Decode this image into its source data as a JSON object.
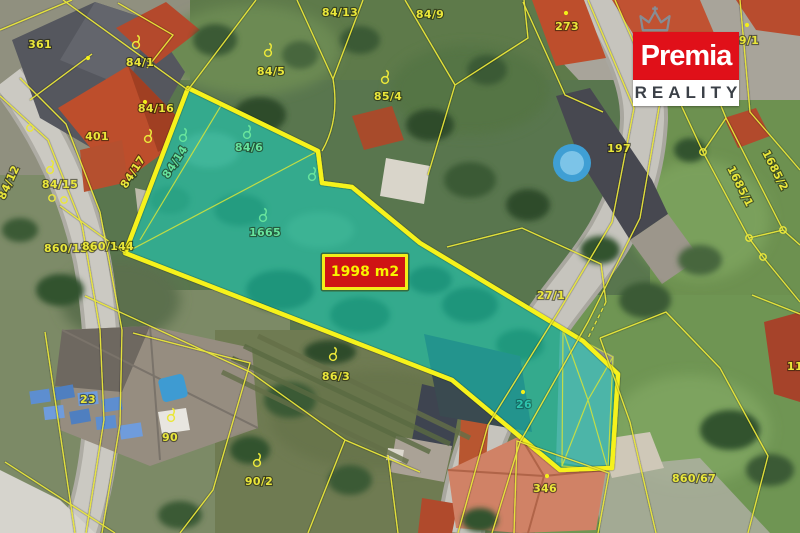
{
  "logo": {
    "brand": "Premia",
    "subtitle": "REALITY",
    "crown_icon": "crown",
    "brand_bg": "#e01019",
    "subtitle_color": "#3b4047"
  },
  "area_label": {
    "text": "1998 m2",
    "bg": "#cf1414",
    "border": "#f2ee19",
    "color": "#f8f400"
  },
  "map": {
    "type": "cadastral-aerial-overlay",
    "highlight_fill": "#0fd8c6",
    "highlight_border": "#f6f21a",
    "parcel_line_color": "#eae73a",
    "label_color": "#eae73a",
    "label_color_in_highlight": "#67e39c",
    "parcel_labels": [
      {
        "text": "361",
        "x": 40,
        "y": 48
      },
      {
        "text": "84/1",
        "x": 140,
        "y": 66
      },
      {
        "text": "401",
        "x": 97,
        "y": 140
      },
      {
        "text": "84/16",
        "x": 156,
        "y": 112
      },
      {
        "text": "84/15",
        "x": 60,
        "y": 188
      },
      {
        "text": "84/12",
        "x": 12,
        "y": 184,
        "rot": -65
      },
      {
        "text": "84/17",
        "x": 136,
        "y": 174,
        "rot": -57
      },
      {
        "text": "860/130",
        "x": 70,
        "y": 252
      },
      {
        "text": "860/144",
        "x": 108,
        "y": 250
      },
      {
        "text": "84/13",
        "x": 340,
        "y": 16
      },
      {
        "text": "84/5",
        "x": 271,
        "y": 75
      },
      {
        "text": "85/4",
        "x": 388,
        "y": 100
      },
      {
        "text": "84/9",
        "x": 430,
        "y": 18
      },
      {
        "text": "273",
        "x": 567,
        "y": 30
      },
      {
        "text": "9/1",
        "x": 749,
        "y": 44
      },
      {
        "text": "197",
        "x": 619,
        "y": 152
      },
      {
        "text": "1685/1",
        "x": 737,
        "y": 188,
        "rot": 63
      },
      {
        "text": "1685/2",
        "x": 772,
        "y": 172,
        "rot": 63
      },
      {
        "text": "27/1",
        "x": 551,
        "y": 299
      },
      {
        "text": "86/3",
        "x": 336,
        "y": 380
      },
      {
        "text": "90/2",
        "x": 259,
        "y": 485
      },
      {
        "text": "23",
        "x": 88,
        "y": 403
      },
      {
        "text": "90",
        "x": 170,
        "y": 441
      },
      {
        "text": "346",
        "x": 545,
        "y": 492
      },
      {
        "text": "860/67",
        "x": 694,
        "y": 482
      },
      {
        "text": "11",
        "x": 795,
        "y": 370
      },
      {
        "text": "84/14",
        "x": 178,
        "y": 164,
        "rot": -57,
        "cls": "green"
      },
      {
        "text": "84/6",
        "x": 249,
        "y": 151,
        "cls": "green"
      },
      {
        "text": "1665",
        "x": 265,
        "y": 236,
        "cls": "green"
      },
      {
        "text": "26",
        "x": 524,
        "y": 408,
        "cls": "teal"
      }
    ],
    "land_use_symbols_yellow": [
      [
        136,
        45
      ],
      [
        268,
        53
      ],
      [
        385,
        80
      ],
      [
        50,
        170
      ],
      [
        148,
        139
      ],
      [
        333,
        357
      ],
      [
        257,
        463
      ],
      [
        171,
        418
      ]
    ],
    "land_use_symbols_green": [
      [
        247,
        135
      ],
      [
        263,
        218
      ],
      [
        183,
        138
      ],
      [
        312,
        177
      ]
    ],
    "boundary_nodes": [
      [
        30,
        128
      ],
      [
        52,
        198
      ],
      [
        64,
        200
      ],
      [
        703,
        152
      ],
      [
        749,
        238
      ],
      [
        763,
        257
      ],
      [
        783,
        230
      ]
    ],
    "point_dots": [
      [
        88,
        58
      ],
      [
        145,
        102
      ],
      [
        566,
        13
      ],
      [
        547,
        476
      ],
      [
        523,
        392
      ],
      [
        747,
        25
      ]
    ]
  }
}
